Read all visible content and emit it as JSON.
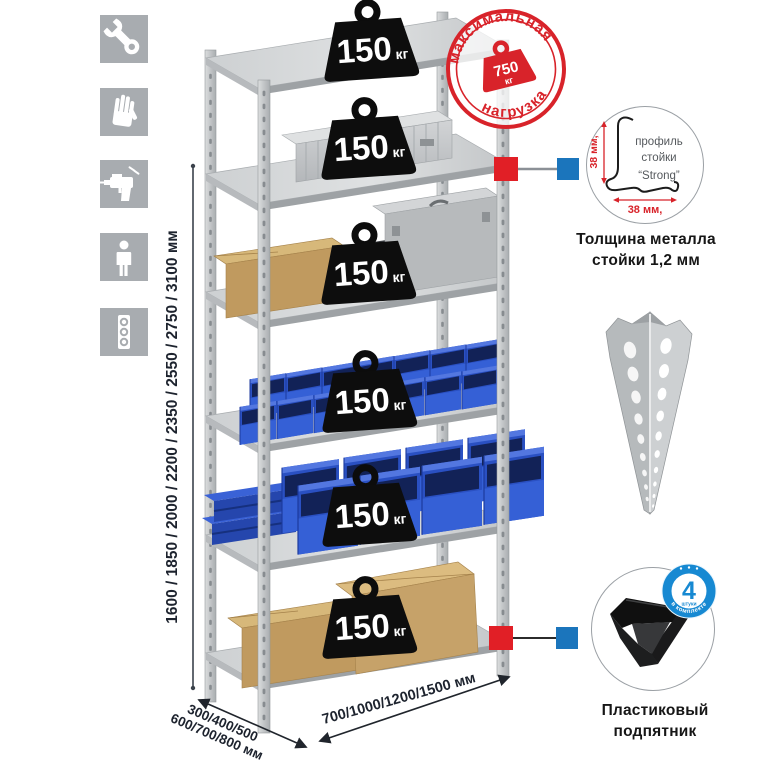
{
  "sidebar": {
    "icons": [
      {
        "name": "wrench-icon"
      },
      {
        "name": "gloves-icon"
      },
      {
        "name": "drill-icon"
      },
      {
        "name": "person-icon"
      },
      {
        "name": "level-icon"
      }
    ]
  },
  "dimensions": {
    "height_label": "1600 / 1850 / 2000 / 2200 / 2350 / 2550 / 2750 / 3100 мм",
    "depth_label_line1": "300/400/500",
    "depth_label_line2": "600/700/800 мм",
    "width_label": "700/1000/1200/1500 мм"
  },
  "shelf": {
    "levels": 6,
    "weights": [
      {
        "value": "150",
        "unit": "кг"
      },
      {
        "value": "150",
        "unit": "кг"
      },
      {
        "value": "150",
        "unit": "кг"
      },
      {
        "value": "150",
        "unit": "кг"
      },
      {
        "value": "150",
        "unit": "кг"
      },
      {
        "value": "150",
        "unit": "кг"
      }
    ]
  },
  "max_load_stamp": {
    "arc_top": "максимальная",
    "arc_bottom": "нагрузка",
    "value": "750",
    "unit": "кг"
  },
  "profile_detail": {
    "line1": "профиль",
    "line2": "стойки",
    "line3": "“Strong”",
    "dim_vertical": "38 мм,",
    "dim_horizontal": "38 мм,",
    "caption_line1": "Толщина металла",
    "caption_line2": "стойки 1,2 мм"
  },
  "foot_detail": {
    "badge_value": "4",
    "badge_small": "штуки",
    "badge_arc": "в комплекте",
    "caption_line1": "Пластиковый",
    "caption_line2": "подпятник"
  },
  "colors": {
    "stamp_red": "#d8232a",
    "connector_red": "#e11f26",
    "connector_blue": "#1b75bc",
    "badge_blue": "#1789d2",
    "bin_blue": "#2a50c2",
    "metal_gray": "#c2c5c7",
    "cardboard": "#c09a5f",
    "dim_text": "#1d232e"
  }
}
